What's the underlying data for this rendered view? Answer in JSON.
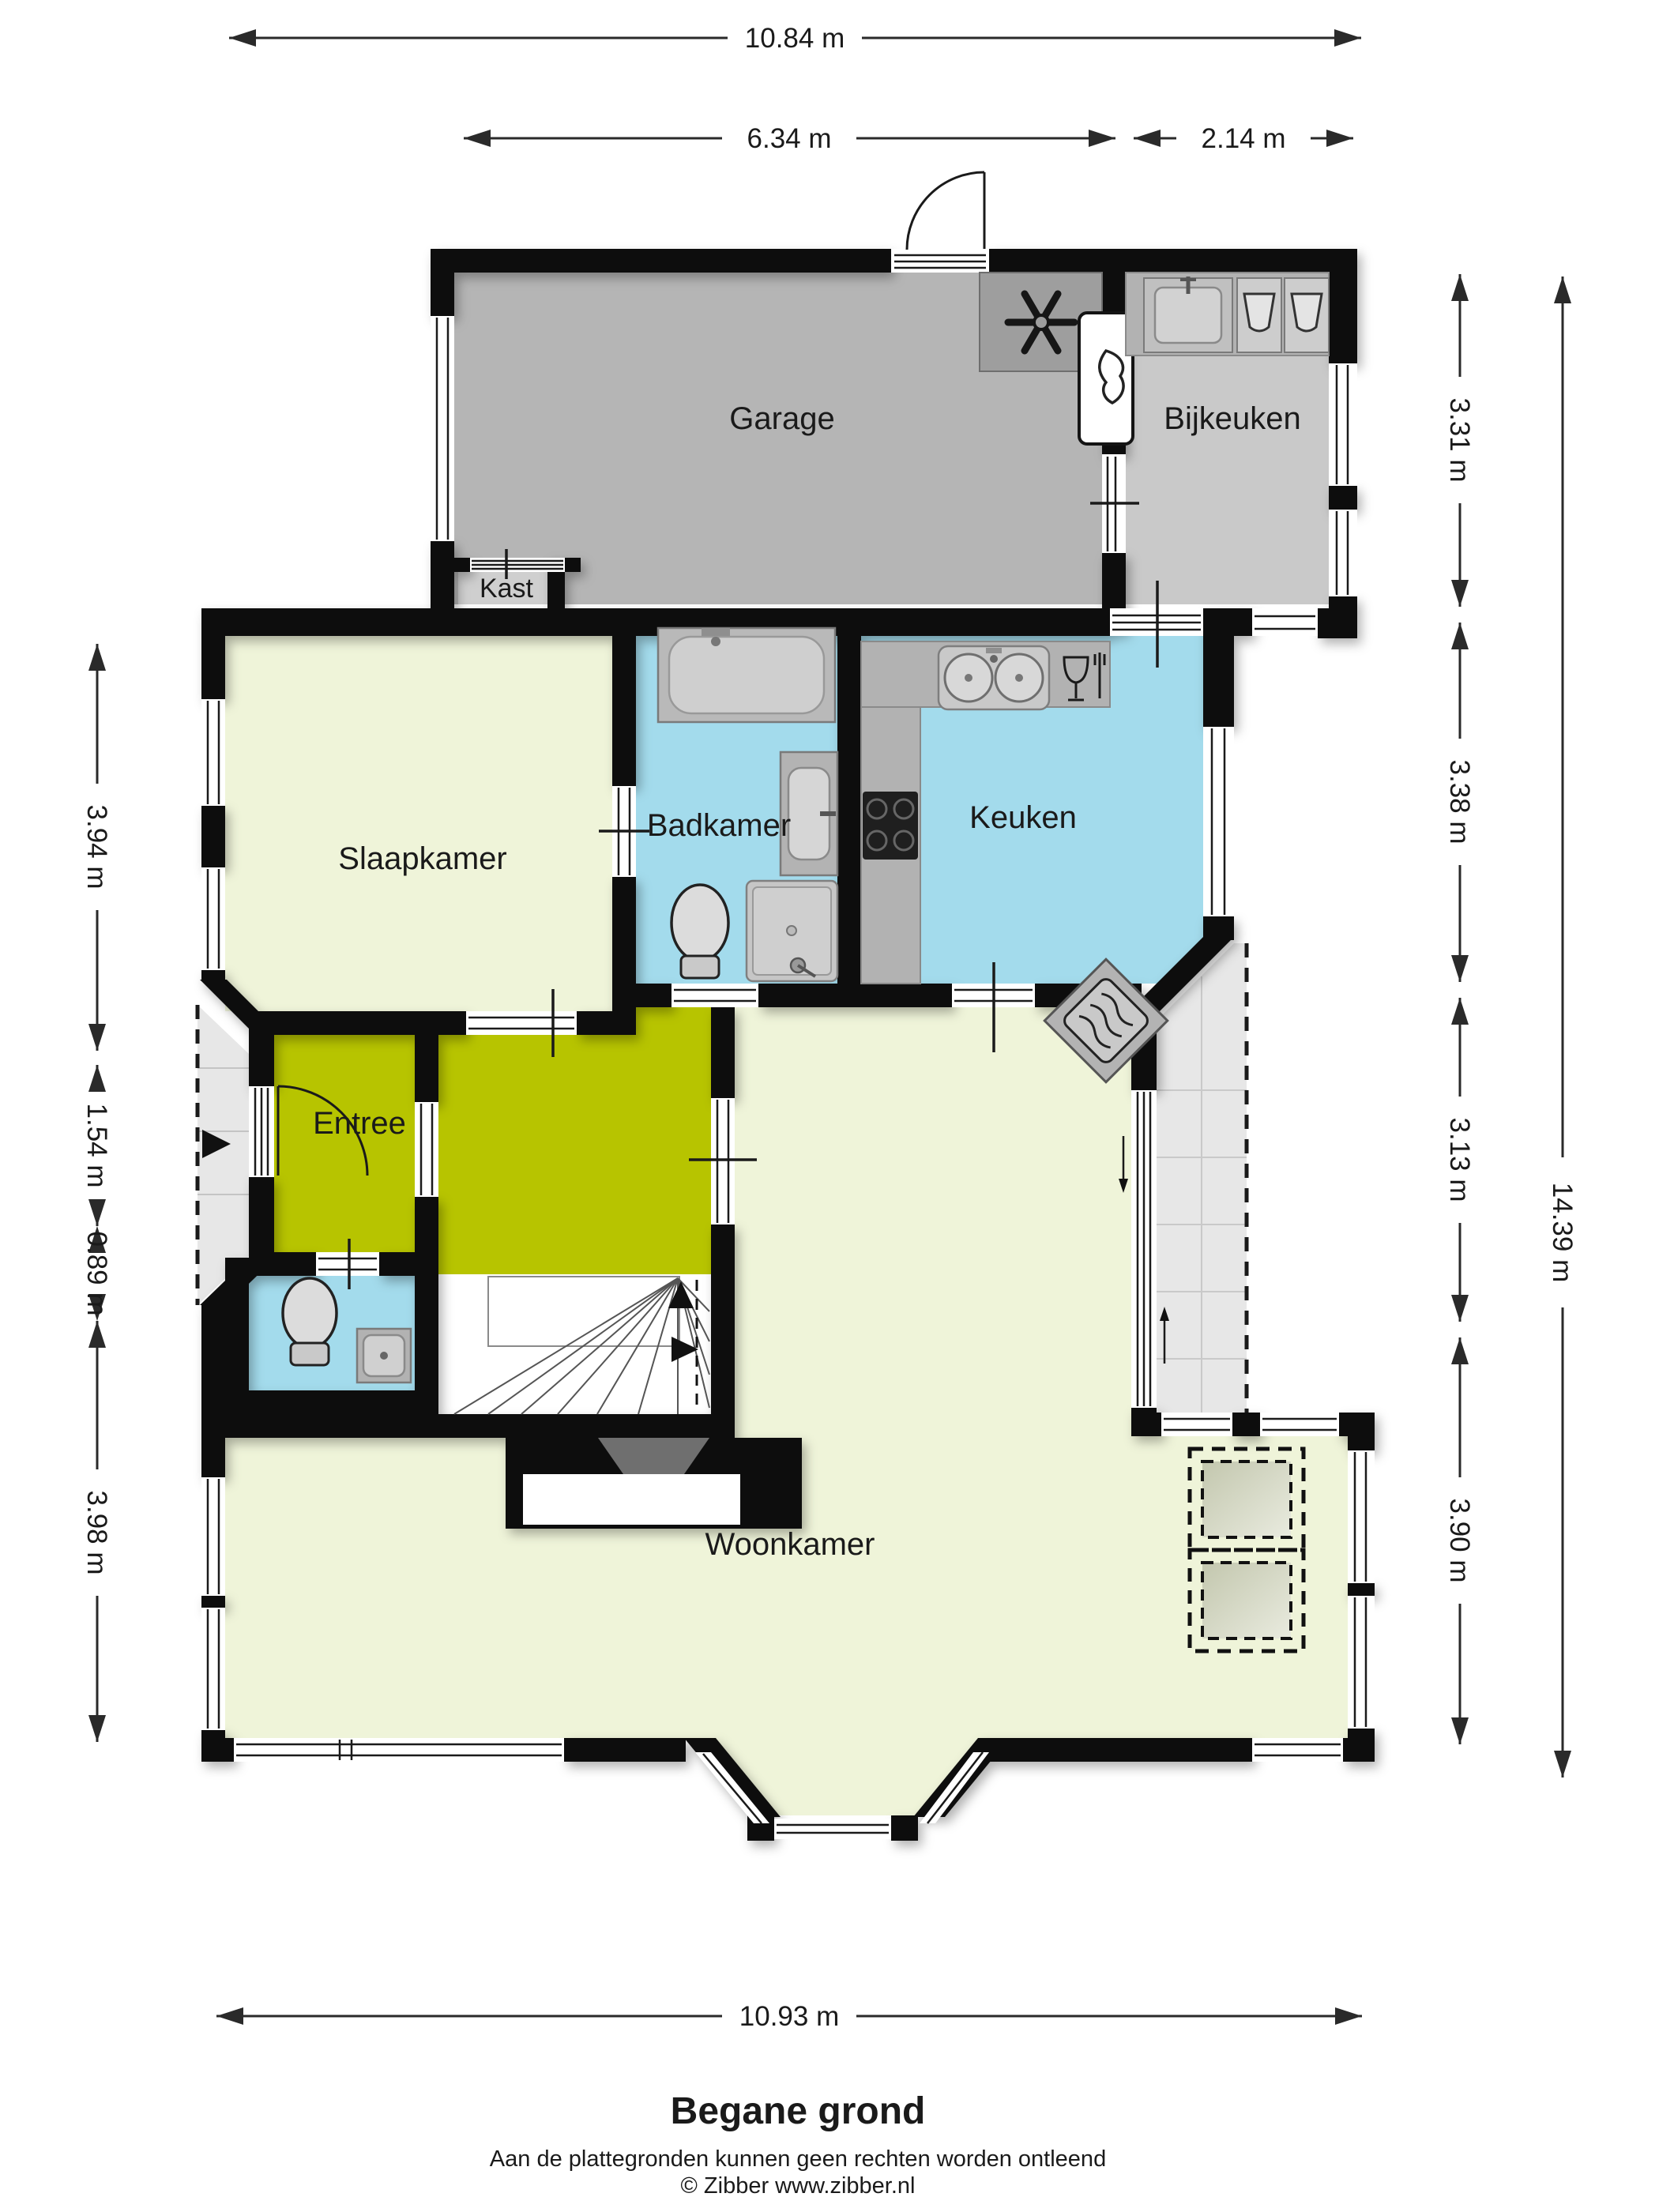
{
  "title": "Begane grond",
  "footer": {
    "disclaimer": "Aan de plattegronden kunnen geen rechten worden ontleend",
    "copyright": "© Zibber www.zibber.nl"
  },
  "rooms": {
    "garage": "Garage",
    "bijkeuken": "Bijkeuken",
    "kast": "Kast",
    "slaapkamer": "Slaapkamer",
    "badkamer": "Badkamer",
    "keuken": "Keuken",
    "entree": "Entree",
    "woonkamer": "Woonkamer"
  },
  "dims": {
    "top_total": "10.84 m",
    "top_garage": "6.34 m",
    "top_bijkeuken": "2.14 m",
    "bottom_total": "10.93 m",
    "left_slaapkamer": "3.94 m",
    "left_entree": "1.54 m",
    "left_toilet": "0.89 m",
    "left_woonkamer": "3.98 m",
    "right_garage": "3.31 m",
    "right_keuken": "3.38 m",
    "right_hal": "3.13 m",
    "right_woonkamer": "3.90 m",
    "right_total": "14.39 m"
  },
  "colors": {
    "wall": "#111111",
    "living_floor": "#eff4d9",
    "entree_floor": "#b7c400",
    "wet_floor": "#a3dbec",
    "garage_floor": "#b5b5b5",
    "bijkeuken_floor": "#c9c9c9",
    "outdoor_tiles": "#e7e7e7",
    "counter": "#b2b2b2"
  },
  "icons": [
    "ventilation-fan-icon",
    "boiler-flame-icon",
    "laundry-sink-icon",
    "washing-machine-icon",
    "bathtub-icon",
    "washbasin-icon",
    "toilet-icon",
    "shower-icon",
    "double-sink-icon",
    "dishwasher-icon",
    "hob-icon",
    "stove-icon",
    "entrance-arrow-icon",
    "stairs-up-arrow-icon",
    "door-swing-icon",
    "skylight-icon"
  ]
}
